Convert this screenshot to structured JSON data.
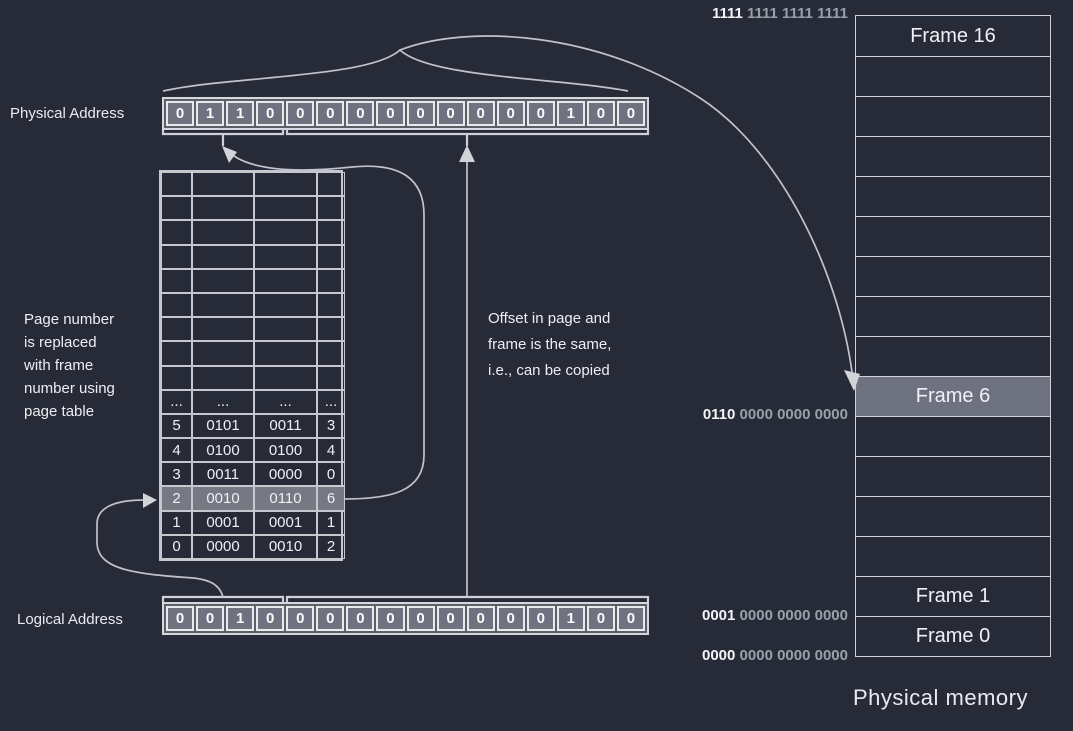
{
  "physical_address": {
    "label": "Physical Address",
    "bits": [
      "0",
      "1",
      "1",
      "0",
      "0",
      "0",
      "0",
      "0",
      "0",
      "0",
      "0",
      "0",
      "0",
      "1",
      "0",
      "0"
    ]
  },
  "logical_address": {
    "label": "Logical Address",
    "bits": [
      "0",
      "0",
      "1",
      "0",
      "0",
      "0",
      "0",
      "0",
      "0",
      "0",
      "0",
      "0",
      "0",
      "1",
      "0",
      "0"
    ]
  },
  "page_table": {
    "empty_row_count": 9,
    "columns": 4,
    "rows": [
      {
        "cells": [
          "...",
          "...",
          "...",
          "..."
        ],
        "highlight": false
      },
      {
        "cells": [
          "5",
          "0101",
          "0011",
          "3"
        ],
        "highlight": false
      },
      {
        "cells": [
          "4",
          "0100",
          "0100",
          "4"
        ],
        "highlight": false
      },
      {
        "cells": [
          "3",
          "0011",
          "0000",
          "0"
        ],
        "highlight": false
      },
      {
        "cells": [
          "2",
          "0010",
          "0110",
          "6"
        ],
        "highlight": true
      },
      {
        "cells": [
          "1",
          "0001",
          "0001",
          "1"
        ],
        "highlight": false
      },
      {
        "cells": [
          "0",
          "0000",
          "0010",
          "2"
        ],
        "highlight": false
      }
    ]
  },
  "annotations": {
    "page_number_note": "Page number\nis replaced\nwith frame\nnumber using\npage table",
    "offset_note": "Offset in page and\nframe is the same,\ni.e., can be copied"
  },
  "memory": {
    "title": "Physical memory",
    "row_count": 16,
    "frames": [
      {
        "row": 0,
        "label": "Frame 16",
        "highlight": false
      },
      {
        "row": 9,
        "label": "Frame 6",
        "highlight": true
      },
      {
        "row": 14,
        "label": "Frame 1",
        "highlight": false
      },
      {
        "row": 15,
        "label": "Frame 0",
        "highlight": false
      }
    ],
    "address_labels": [
      {
        "bold": "1111",
        "rest": "1111 1111 1111",
        "boundary_row": 0
      },
      {
        "bold": "0110",
        "rest": "0000 0000 0000",
        "boundary_row": 10
      },
      {
        "bold": "0001",
        "rest": "0000 0000 0000",
        "boundary_row": 15
      },
      {
        "bold": "0000",
        "rest": "0000 0000 0000",
        "boundary_row": 16
      }
    ]
  },
  "colors": {
    "background": "#272b38",
    "cell_fill": "#6f7380",
    "highlight_fill": "#757984",
    "cell_border": "#e8eaec",
    "table_border": "#c6c8ce",
    "connector_line": "#c0c3cc",
    "text_bright": "#f3f4f7",
    "text_dim": "#9aa0ab"
  }
}
